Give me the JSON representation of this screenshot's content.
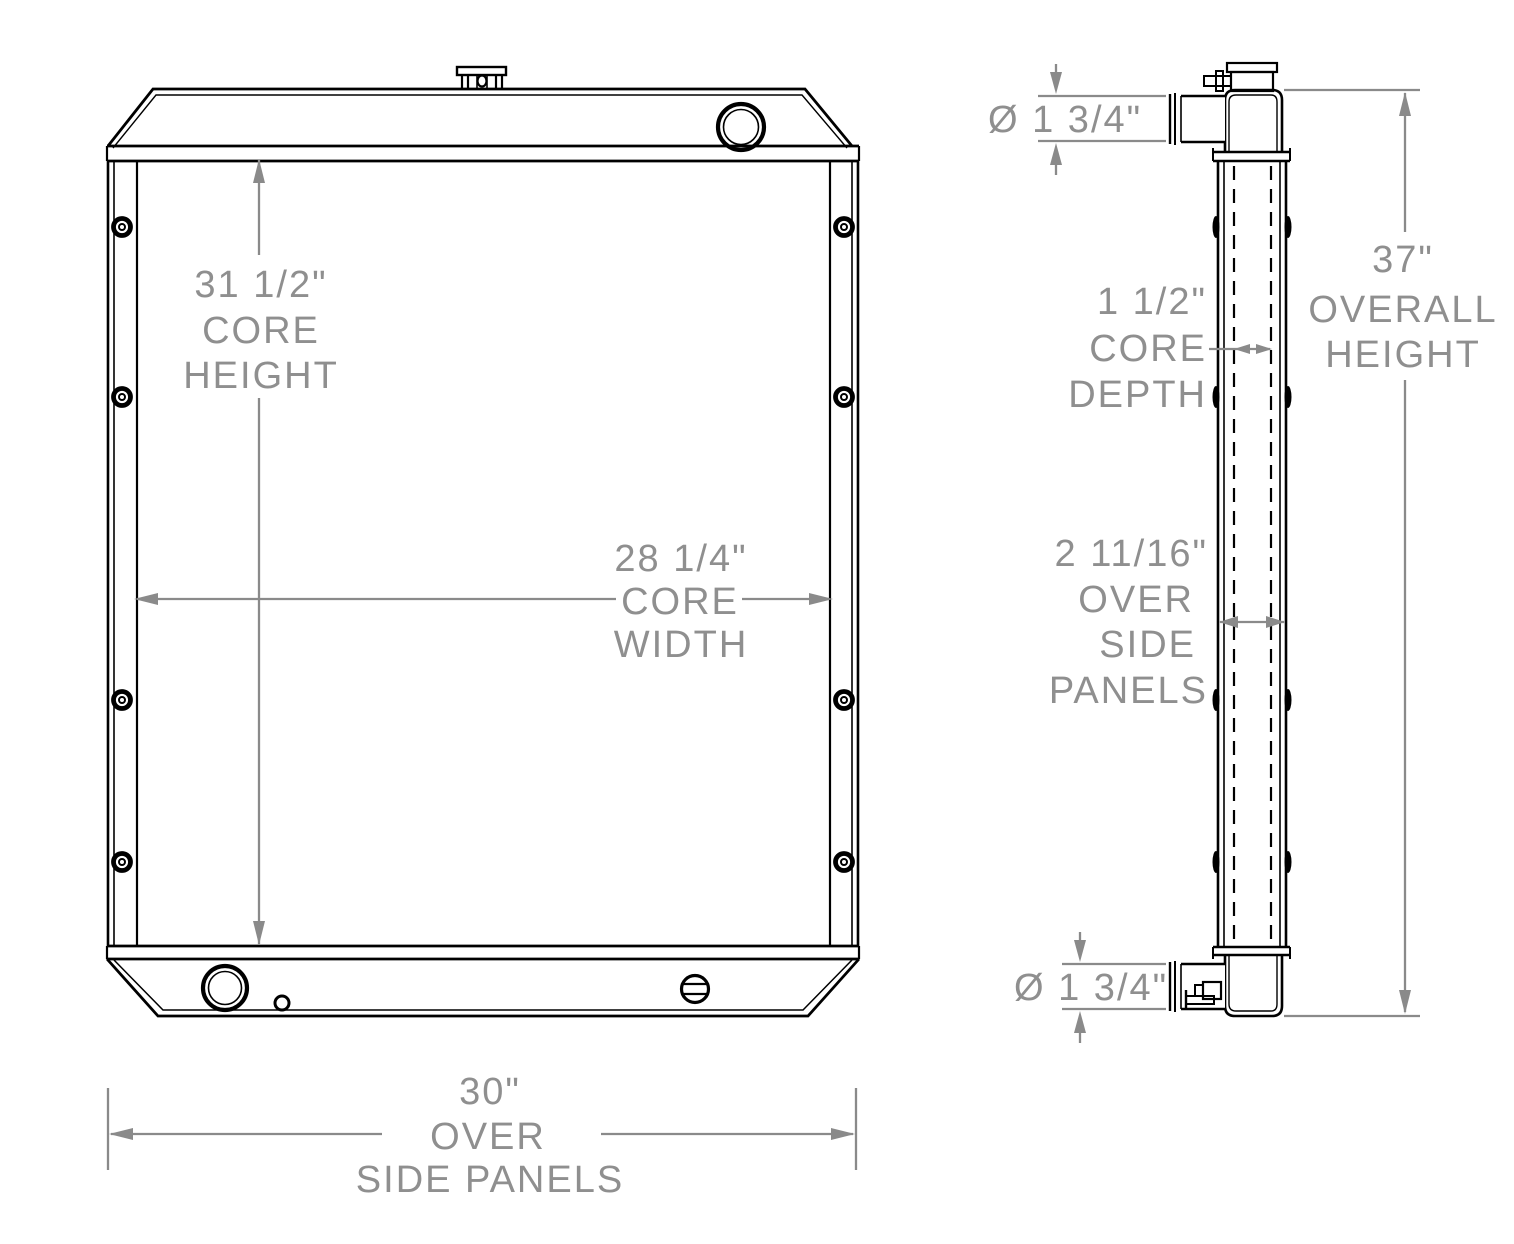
{
  "drawing": {
    "type": "technical-dimension-drawing",
    "subject": "radiator",
    "views": {
      "front": "front-view",
      "side": "side-view"
    },
    "dims": {
      "core_height": {
        "value_in": 31.5,
        "lines": [
          "31 1/2\"",
          "CORE",
          "HEIGHT"
        ]
      },
      "core_width": {
        "value_in": 28.25,
        "lines": [
          "28 1/4\"",
          "CORE",
          "WIDTH"
        ]
      },
      "overall_width": {
        "value_in": 30,
        "lines": [
          "30\"",
          "OVER",
          "SIDE PANELS"
        ]
      },
      "inlet_diameter": {
        "value_in": 1.75,
        "lines": [
          "Ø 1 3/4\""
        ]
      },
      "core_depth": {
        "value_in": 1.5,
        "lines": [
          "1 1/2\"",
          "CORE",
          "DEPTH"
        ]
      },
      "overall_height": {
        "value_in": 37,
        "lines": [
          "37\"",
          "OVERALL",
          "HEIGHT"
        ]
      },
      "overall_depth": {
        "value_in": 2.6875,
        "lines": [
          "2 11/16\"",
          "OVER",
          "SIDE",
          "PANELS"
        ]
      },
      "outlet_diameter": {
        "value_in": 1.75,
        "lines": [
          "Ø 1 3/4\""
        ]
      }
    },
    "colors": {
      "outline": "#000000",
      "dimension": "#8a8a8a",
      "dimension_text": "#8f8f8f",
      "background": "#ffffff"
    }
  }
}
